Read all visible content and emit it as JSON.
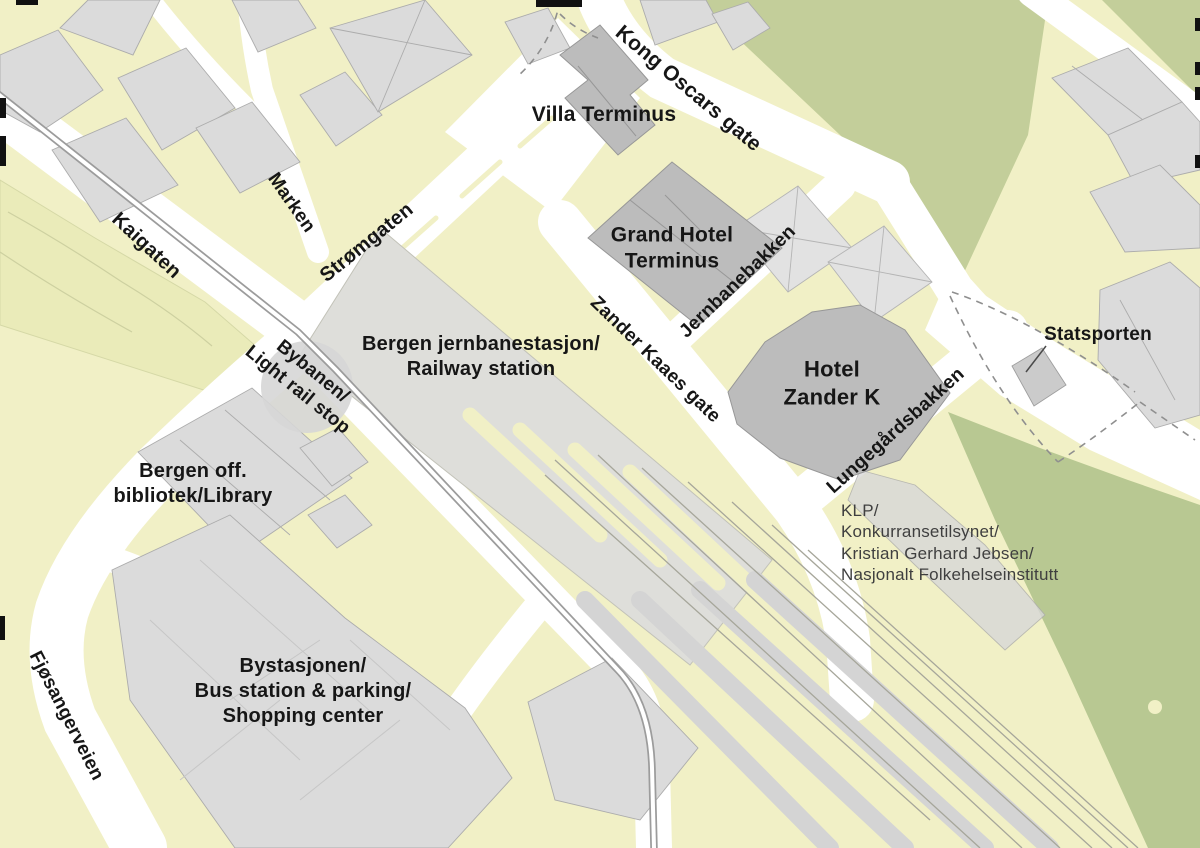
{
  "map": {
    "colors": {
      "land": "#F1F0C6",
      "road": "#FFFFFF",
      "park": "#C3CE9A",
      "park_dark": "#B8C892",
      "park_light": "#EAEBB9",
      "building": "#DBDBDB",
      "building_outline": "#ACACAC",
      "highlighted_building": "#BCBCBC",
      "station_area": "#DEDEDA",
      "rail_line": "#A6A69A",
      "tram_line": "#9C9C9C",
      "label": "#161616",
      "label_secondary": "#3F3F3F",
      "edge_mark": "#111111"
    },
    "labels": [
      {
        "id": "villa-terminus",
        "lines": [
          "Villa Terminus"
        ],
        "x": 604,
        "y": 115,
        "rotation": 0,
        "size": 21
      },
      {
        "id": "kong-oscars-gate",
        "lines": [
          "Kong Oscars gate"
        ],
        "x": 688,
        "y": 89,
        "rotation": 40,
        "size": 21
      },
      {
        "id": "grand-hotel-terminus",
        "lines": [
          "Grand Hotel",
          "Terminus"
        ],
        "x": 672,
        "y": 249,
        "rotation": 0,
        "size": 21
      },
      {
        "id": "jernbanebakken",
        "lines": [
          "Jernbanebakken"
        ],
        "x": 738,
        "y": 282,
        "rotation": -44,
        "size": 19
      },
      {
        "id": "statsporten",
        "lines": [
          "Statsporten"
        ],
        "x": 1098,
        "y": 335,
        "rotation": 0,
        "size": 19
      },
      {
        "id": "zander-kaaes-gate",
        "lines": [
          "Zander Kaaes gate"
        ],
        "x": 655,
        "y": 360,
        "rotation": 44,
        "size": 19
      },
      {
        "id": "hotel-zander-k",
        "lines": [
          "Hotel",
          "Zander K"
        ],
        "x": 832,
        "y": 383,
        "rotation": 0,
        "size": 22
      },
      {
        "id": "lungegardsbakken",
        "lines": [
          "Lungegårdsbakken"
        ],
        "x": 896,
        "y": 431,
        "rotation": -42,
        "size": 19
      },
      {
        "id": "klp",
        "lines": [
          "KLP/",
          "Konkurransetilsynet/",
          "Kristian Gerhard Jebsen/",
          "Nasjonalt Folkehelseinstitutt"
        ],
        "x": 841,
        "y": 500,
        "rotation": 0,
        "size": 17,
        "weight": 400,
        "color": "#3F3F3F",
        "anchor": "topleft",
        "align": "left"
      },
      {
        "id": "kaigaten",
        "lines": [
          "Kaigaten"
        ],
        "x": 146,
        "y": 246,
        "rotation": 43,
        "size": 20
      },
      {
        "id": "marken",
        "lines": [
          "Marken"
        ],
        "x": 291,
        "y": 203,
        "rotation": 55,
        "size": 19
      },
      {
        "id": "stromgaten",
        "lines": [
          "Strømgaten"
        ],
        "x": 367,
        "y": 243,
        "rotation": -39,
        "size": 20
      },
      {
        "id": "bybanen-light-rail-stop",
        "lines": [
          "Bybanen/",
          "Light rail stop"
        ],
        "x": 305,
        "y": 381,
        "rotation": 39,
        "size": 19
      },
      {
        "id": "bergen-jernbanestasjon",
        "lines": [
          "Bergen jernbanestasjon/",
          "Railway station"
        ],
        "x": 481,
        "y": 357,
        "rotation": 0,
        "size": 20
      },
      {
        "id": "bergen-bibliotek",
        "lines": [
          "Bergen off.",
          "bibliotek/Library"
        ],
        "x": 193,
        "y": 484,
        "rotation": 0,
        "size": 20
      },
      {
        "id": "bystasjonen",
        "lines": [
          "Bystasjonen/",
          "Bus station & parking/",
          "Shopping center"
        ],
        "x": 303,
        "y": 692,
        "rotation": 0,
        "size": 20
      },
      {
        "id": "fjosangerveien",
        "lines": [
          "Fjøsangerveien"
        ],
        "x": 66,
        "y": 716,
        "rotation": 63,
        "size": 19
      }
    ]
  }
}
